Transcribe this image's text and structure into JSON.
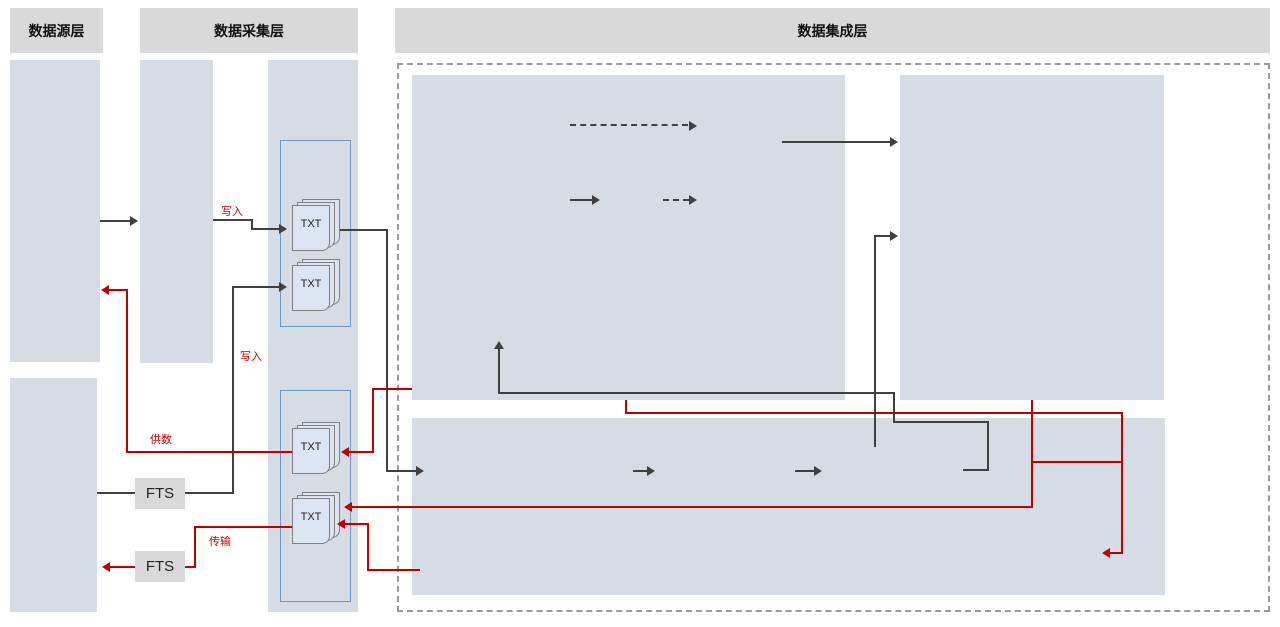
{
  "headers": {
    "source": "数据源层",
    "collection": "数据采集层",
    "integration": "数据集成层"
  },
  "source_layer": {
    "self_built": {
      "title": "自建数据源",
      "items": [
        "信贷",
        "特色",
        "其他"
      ]
    },
    "unified": {
      "title": "统建数据源",
      "items": [
        "CBUS",
        "XBUS",
        "其他"
      ]
    }
  },
  "collection_layer": {
    "unified_collection": "统一数\n据采集",
    "fts_top": "FTS",
    "fts_bottom": "FTS"
  },
  "exchange": {
    "title": "数据交换",
    "receive_label": "数据\n接收区",
    "send_label": "数据\n发送区",
    "txt": "TXT"
  },
  "flows": {
    "write_top": "写入",
    "write_mid": "写入",
    "supply": "供数",
    "transfer": "传输"
  },
  "dws": {
    "title": "数据仓库（DWS）",
    "fds": "主题层（FDS）",
    "ads": "汇总层\n(ADS)",
    "pds": "公共访问层\n(PDS)"
  },
  "marts": {
    "title": "数据集市",
    "groups": [
      {
        "label": "数据应用",
        "item": "客户集市"
      },
      {
        "label": "数据应用",
        "item": "报表集市"
      },
      {
        "label": "数据应用",
        "item": "监管集市"
      }
    ],
    "right": {
      "label": "数据应用",
      "items": [
        "零售集市",
        "对公集市",
        "金市集市",
        "风险集市",
        "财务集市",
        "人力集市",
        "运营集市"
      ]
    }
  },
  "mrs": {
    "title": "数据湖（MRS）",
    "zones": [
      "贴源数据区",
      "数据标准区",
      "数据整合区"
    ],
    "history": "历史数据区"
  },
  "colors": {
    "accent_red": "#c00000",
    "line_black": "#404040",
    "panel_blue": "#d6dce4",
    "header_gray": "#d9d9d9",
    "box_border_blue": "#5b9bd5"
  }
}
